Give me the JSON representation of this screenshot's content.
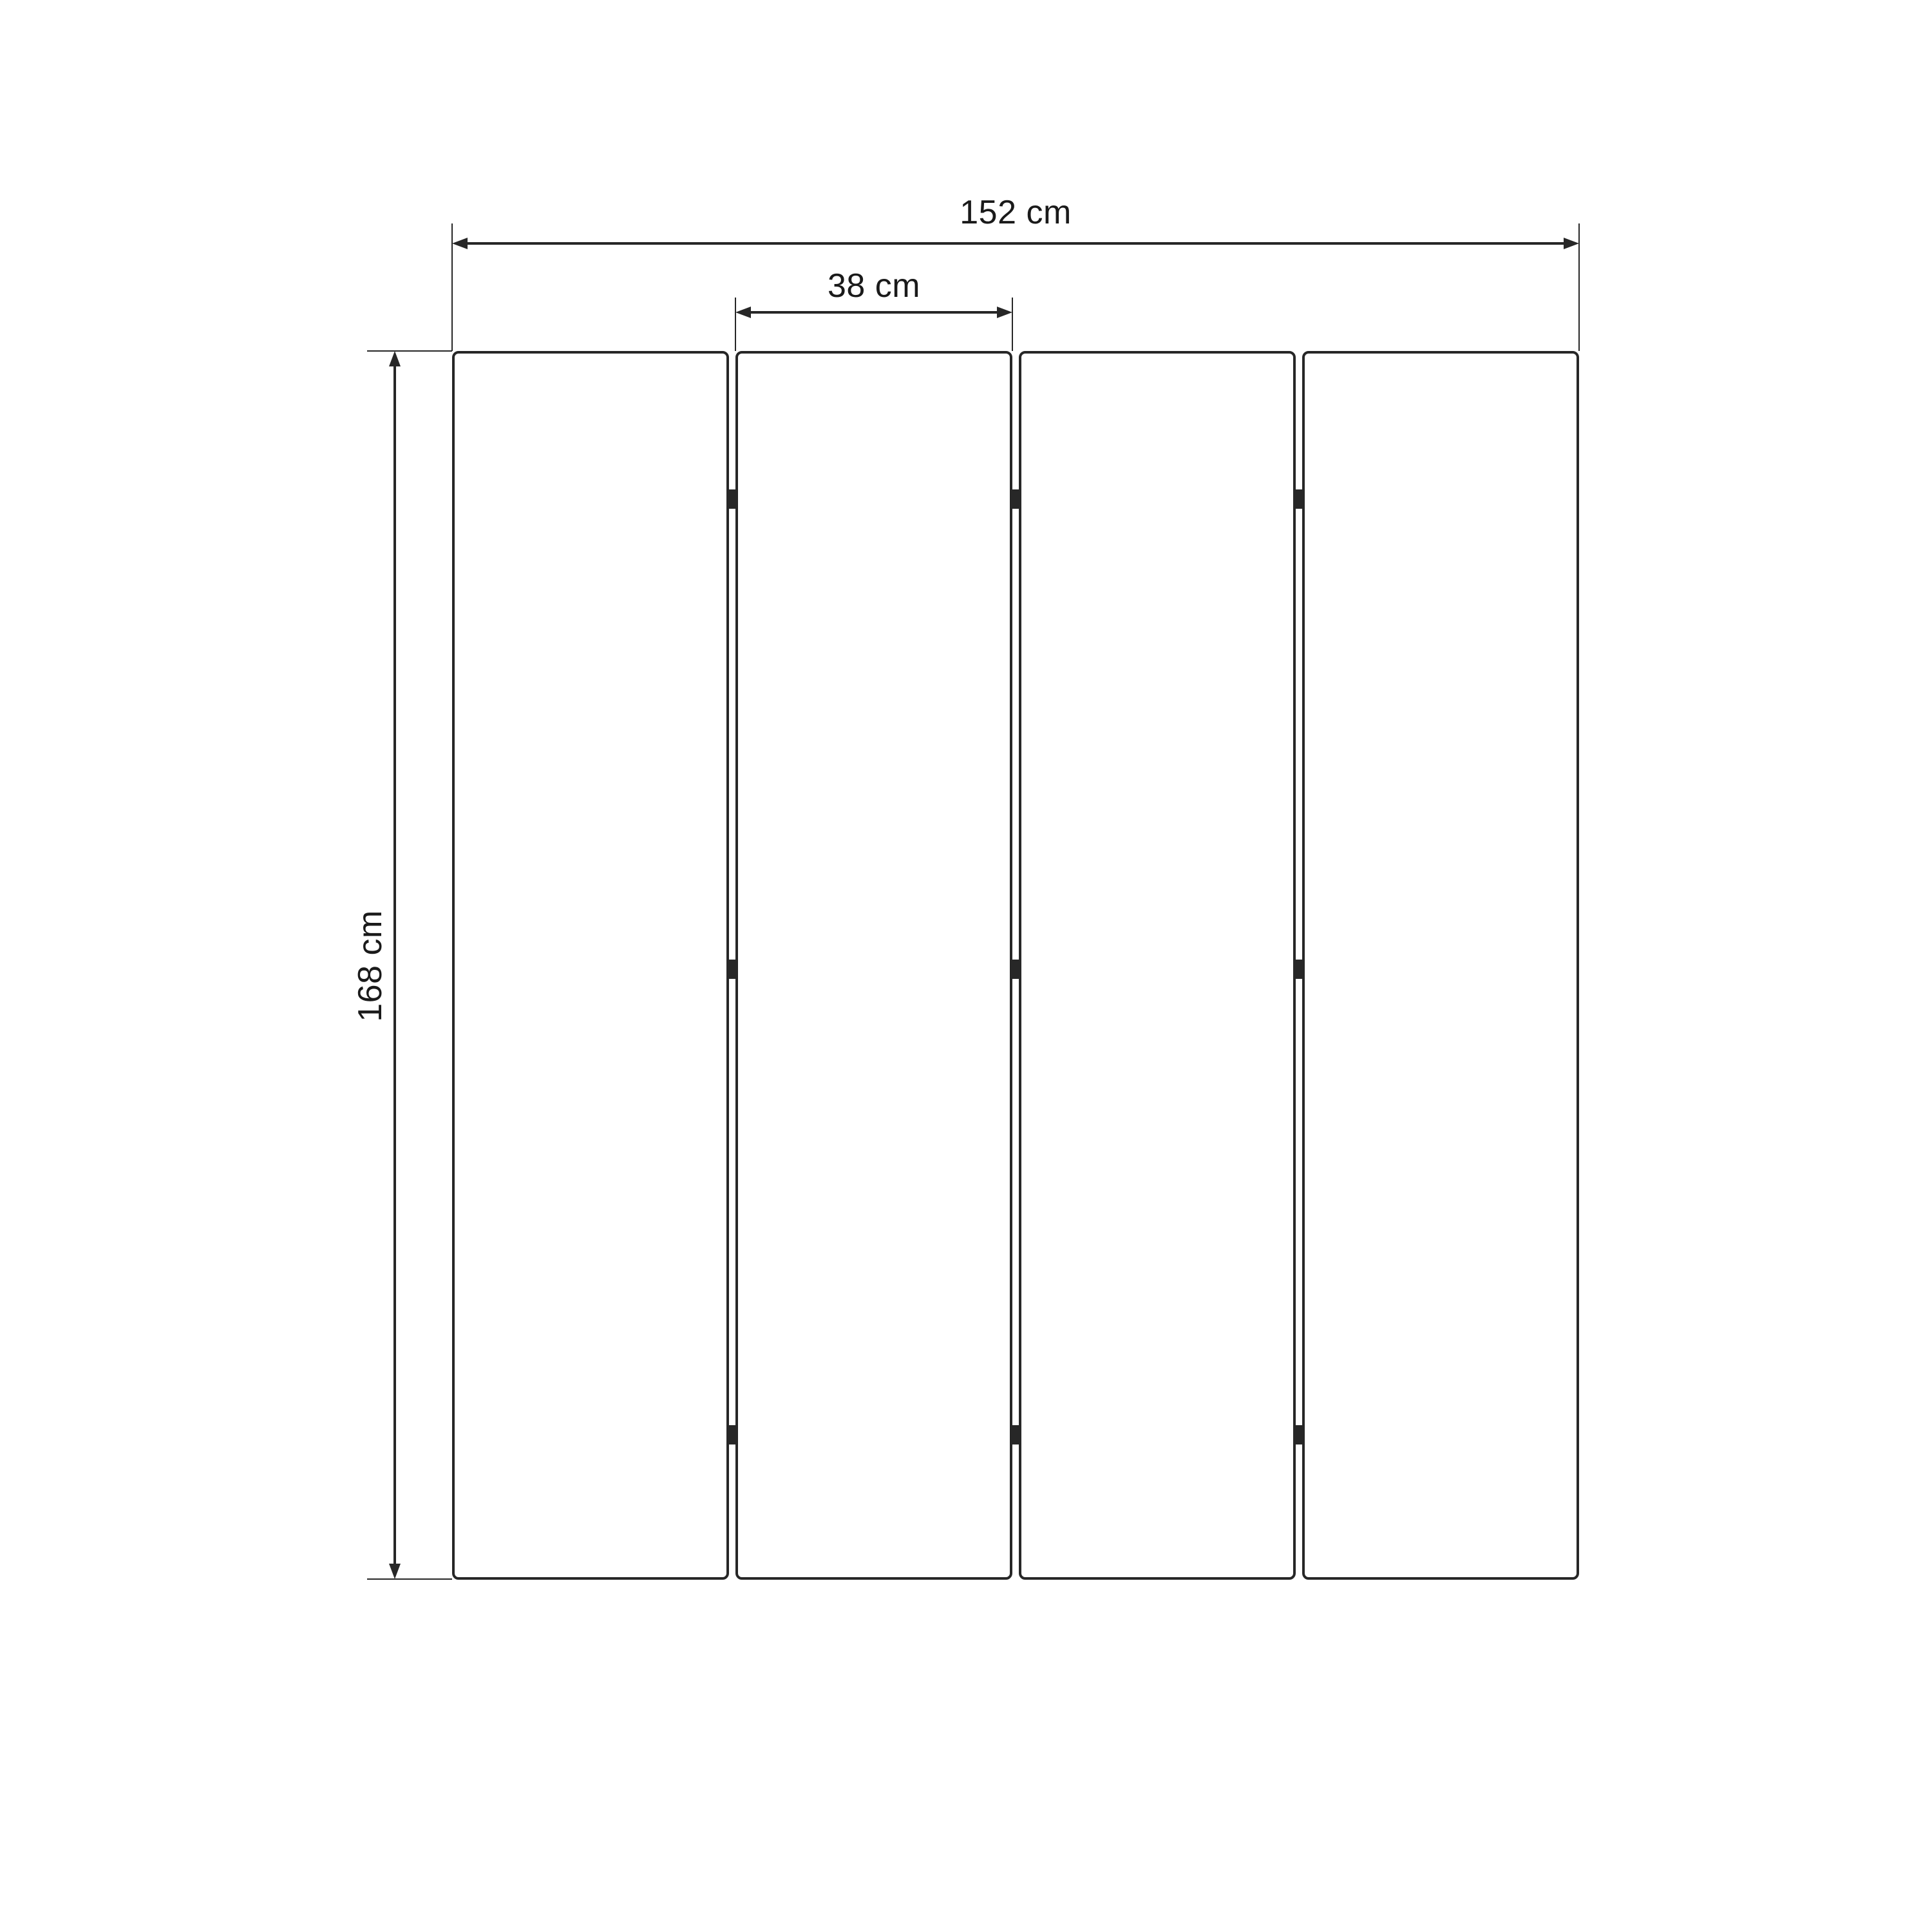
{
  "diagram": {
    "type": "technical-dimension-drawing",
    "subject": "four-panel folding screen, front elevation",
    "background_color": "#ffffff",
    "line_color": "#272727",
    "text_color": "#1a1a1a",
    "labels": {
      "total_width": "152 cm",
      "panel_width": "38 cm",
      "height": "168 cm"
    },
    "structure": {
      "panel_count": 4,
      "joint_count": 3,
      "hinges_per_joint": 3
    }
  }
}
